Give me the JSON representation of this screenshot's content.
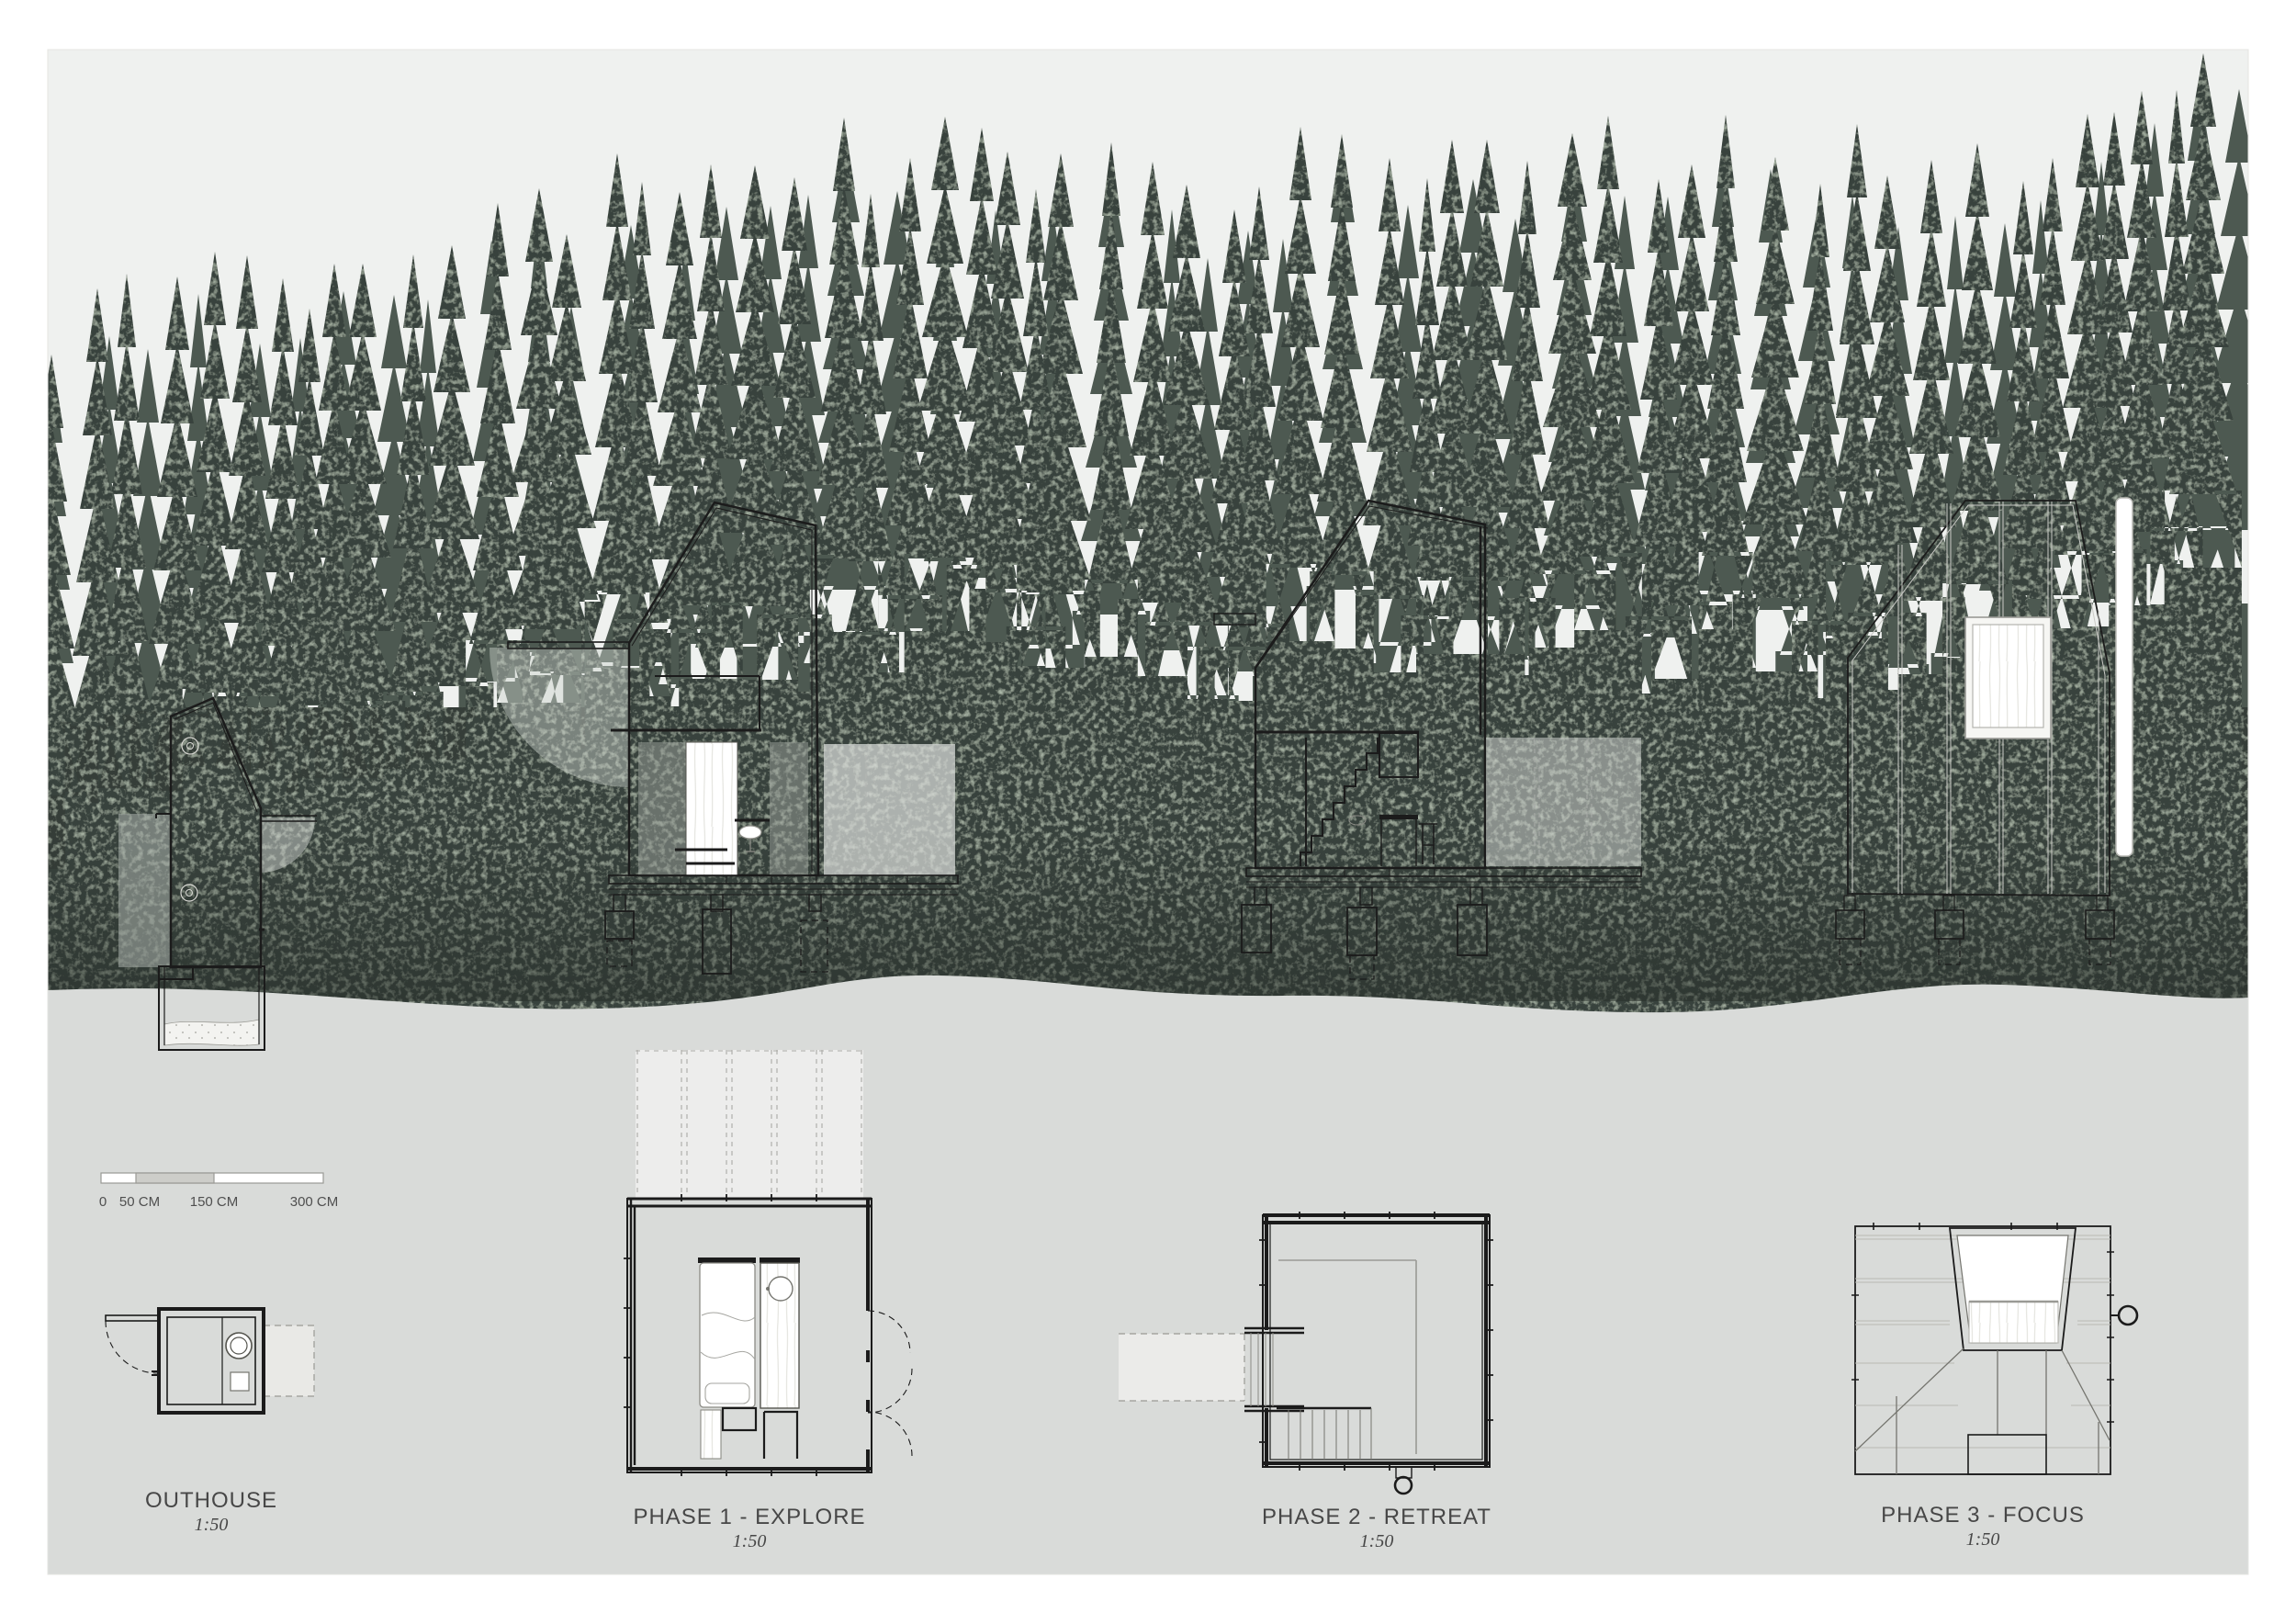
{
  "board_type": "architectural presentation board",
  "drawings": [
    {
      "id": "outhouse",
      "label": "OUTHOUSE",
      "scale": "1:50",
      "views": [
        "section elevation",
        "floor plan"
      ]
    },
    {
      "id": "phase1",
      "label": "PHASE 1 - EXPLORE",
      "scale": "1:50",
      "views": [
        "section elevation",
        "floor plan with dashed deck"
      ]
    },
    {
      "id": "phase2",
      "label": "PHASE 2 - RETREAT",
      "scale": "1:50",
      "views": [
        "section elevation with stair",
        "floor plan with entry ramp"
      ]
    },
    {
      "id": "phase3",
      "label": "PHASE 3 - FOCUS",
      "scale": "1:50",
      "views": [
        "exterior elevation with chimney",
        "roof plan with skylight"
      ]
    }
  ],
  "scale_bar": {
    "labels": [
      "0",
      "50 CM",
      "150 CM",
      "300 CM"
    ]
  },
  "colors": {
    "paper": "#ffffff",
    "sky": "#eff1ef",
    "forest_front": "#39433c",
    "forest_back": "#4d5951",
    "forest_base": "#343d37",
    "forest_speckle": "#6b7a65",
    "ground": "#d9dbd9",
    "drawing_line": "#1b1b1b",
    "overlay_gray": "#aab0ac",
    "overlay_light": "#d9dcd9",
    "wood_grain": "#e7e7e2",
    "label_text": "#474747"
  }
}
